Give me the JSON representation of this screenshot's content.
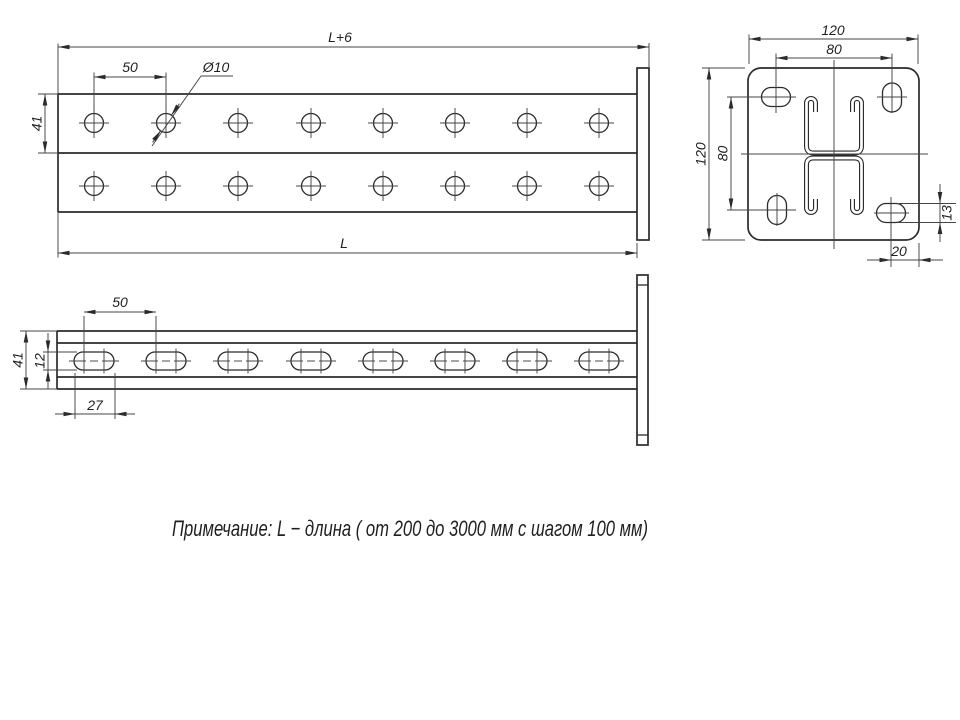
{
  "colors": {
    "background": "#ffffff",
    "line": "#2b2b2b",
    "thin_line": "#454545",
    "text": "#1f1f1f"
  },
  "note": {
    "text": "Примечание: L − длина ( от 200 до 3000 мм с шагом 100 мм)"
  },
  "front_view": {
    "description": "plan view of double strut with end plate",
    "dim_total_length": "L+6",
    "dim_length": "L",
    "dim_hole_spacing": "50",
    "dim_hole_diameter": "Ø10",
    "dim_flange_width": "41",
    "hole_columns": 8,
    "hole_rows": 2
  },
  "side_view": {
    "description": "side view of strut with slotted holes",
    "dim_slot_spacing": "50",
    "dim_height": "41",
    "dim_slot_width": "12",
    "dim_slot_length": "27",
    "slot_count": 8
  },
  "end_view": {
    "description": "end plate view with strut cross-section",
    "dim_width": "120",
    "dim_hole_spacing_h": "80",
    "dim_height": "120",
    "dim_hole_spacing_v": "80",
    "dim_corner_slot_offset": "20",
    "dim_corner_slot_height": "13"
  }
}
